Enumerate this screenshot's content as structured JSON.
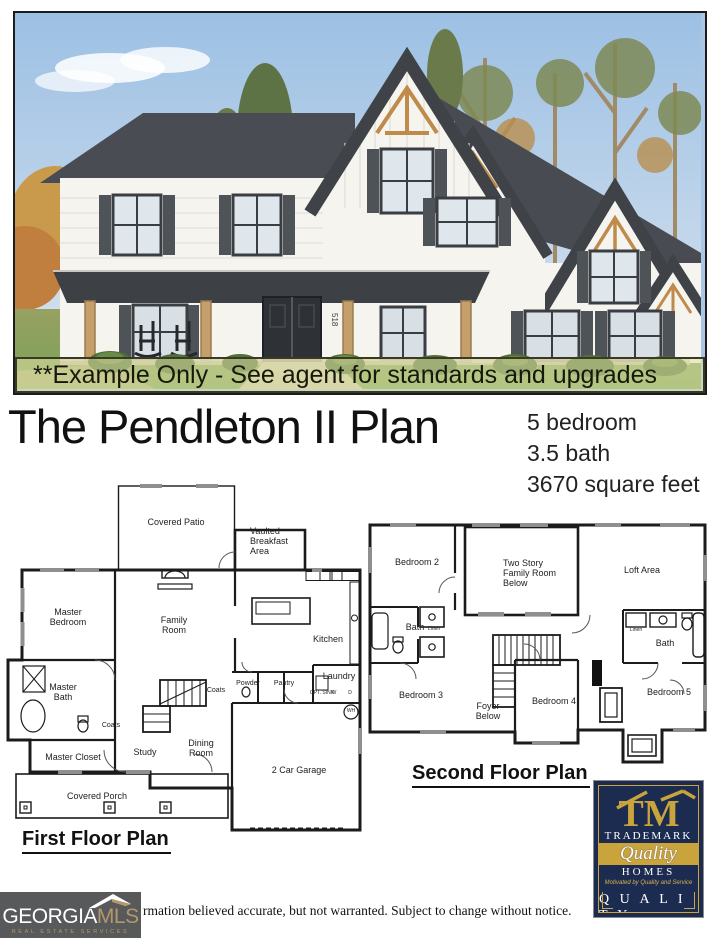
{
  "banner": {
    "text": "**Example Only - See agent for standards and upgrades"
  },
  "header": {
    "title": "The Pendleton II Plan",
    "bedrooms": "5 bedroom",
    "baths": "3.5 bath",
    "sqft": "3670 square feet"
  },
  "photo": {
    "house_number": "518"
  },
  "first_floor": {
    "heading": "First Floor Plan",
    "rooms": {
      "covered_patio": "Covered Patio",
      "vaulted_breakfast": "Vaulted Breakfast Area",
      "master_bedroom": "Master Bedroom",
      "family_room": "Family Room",
      "kitchen": "Kitchen",
      "laundry": "Laundry",
      "powder": "Powder",
      "pantry": "Pantry",
      "coats_hall": "Coats",
      "coats_master": "Coats",
      "master_bath": "Master Bath",
      "master_closet": "Master Closet",
      "study": "Study",
      "dining_room": "Dining Room",
      "garage": "2 Car Garage",
      "covered_porch": "Covered Porch"
    },
    "fixtures": {
      "washer": "W",
      "dryer": "D",
      "opt_sink": "OPT. SINK",
      "water_heater": "WH"
    }
  },
  "second_floor": {
    "heading": "Second Floor Plan",
    "rooms": {
      "bedroom2": "Bedroom 2",
      "two_story": "Two Story Family Room Below",
      "loft": "Loft Area",
      "bath_left": "Bath",
      "linen_left": "Linen",
      "bath_right": "Bath",
      "linen_right": "Linen",
      "bedroom3": "Bedroom 3",
      "foyer_below": "Foyer Below",
      "bedroom4": "Bedroom 4",
      "bedroom5": "Bedroom 5"
    }
  },
  "tm_logo": {
    "monogram": "TM",
    "trademark": "TRADEMARK",
    "quality_script": "Quality",
    "homes": "HOMES",
    "tagline": "Motivated by Quality and Service",
    "quality_large": "Q U A L I T Y",
    "is_our_trademark": "IS OUR TRADEMARK"
  },
  "gamls_logo": {
    "georgia": "GEORGIA",
    "mls": "MLS",
    "tagline": "REAL ESTATE SERVICES"
  },
  "disclaimer": "rmation believed accurate, but not warranted. Subject to change without notice."
}
